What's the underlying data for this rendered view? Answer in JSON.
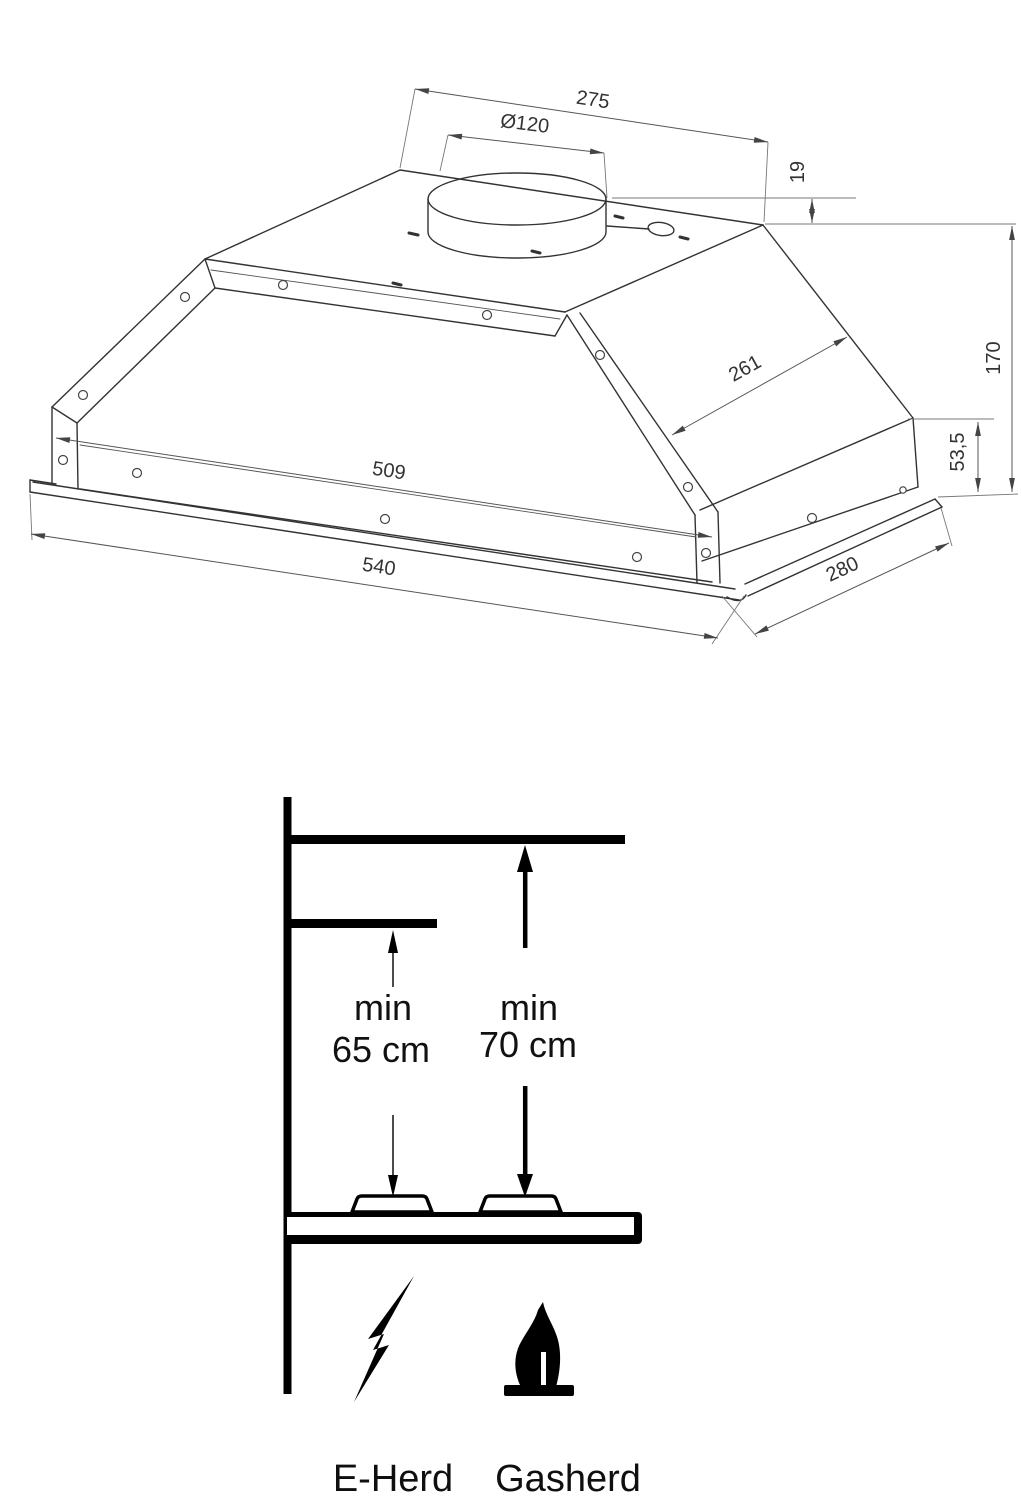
{
  "drawing": {
    "title": "cooker-hood-technical-drawing",
    "dimensions": {
      "top_width": "275",
      "duct_diameter": "Ø120",
      "collar_height": "19",
      "total_height": "170",
      "body_height": "53,5",
      "slope_depth": "261",
      "inner_width": "509",
      "outer_width": "540",
      "outer_depth": "280"
    },
    "line_color": "#333333"
  },
  "installation": {
    "electric": {
      "min_label": "min",
      "distance": "65 cm",
      "appliance": "E-Herd"
    },
    "gas": {
      "min_label": "min",
      "distance": "70 cm",
      "appliance": "Gasherd"
    },
    "icons": {
      "electric": "lightning-icon",
      "gas": "flame-icon"
    },
    "color": "#000000"
  }
}
